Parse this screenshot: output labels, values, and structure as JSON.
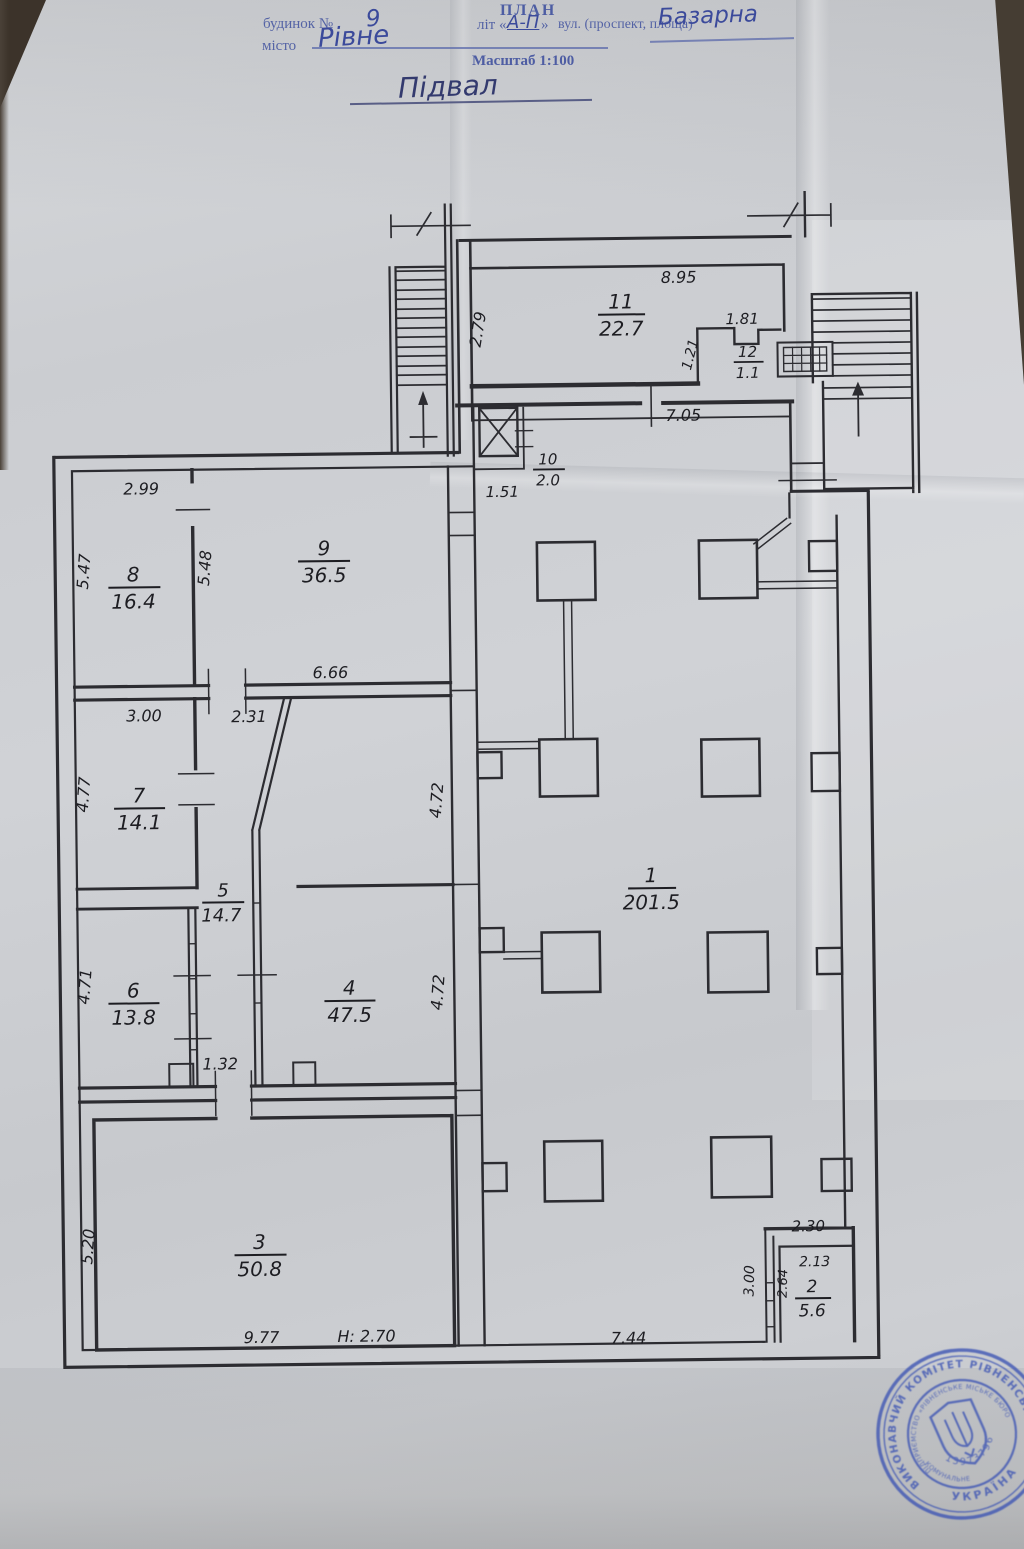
{
  "header": {
    "plan_stamp": "ПЛАН",
    "house_label": "будинок №",
    "house_number": "9",
    "lit_label": "літ «",
    "lit_value": "А-П",
    "lit_close": "»",
    "street_label": "вул. (проспект, площа)",
    "street_value": "Базарна",
    "city_label": "місто",
    "city_value": "Рівне",
    "scale_label": "Масштаб 1:100",
    "title": "Підвал"
  },
  "plan": {
    "rooms": [
      {
        "number": "1",
        "area": "201.5"
      },
      {
        "number": "2",
        "area": "5.6"
      },
      {
        "number": "3",
        "area": "50.8"
      },
      {
        "number": "4",
        "area": "47.5"
      },
      {
        "number": "5",
        "area": "14.7"
      },
      {
        "number": "6",
        "area": "13.8"
      },
      {
        "number": "7",
        "area": "14.1"
      },
      {
        "number": "8",
        "area": "16.4"
      },
      {
        "number": "9",
        "area": "36.5"
      },
      {
        "number": "10",
        "area": "2.0"
      },
      {
        "number": "11",
        "area": "22.7"
      },
      {
        "number": "12",
        "area": "1.1"
      }
    ],
    "dims": {
      "w299": "2.99",
      "h547": "5.47",
      "h548": "5.48",
      "w666": "6.66",
      "w300": "3.00",
      "h477": "4.77",
      "w231": "2.31",
      "h472a": "4.72",
      "h471": "4.71",
      "h472b": "4.72",
      "w132": "1.32",
      "h520": "5.20",
      "w977": "9.77",
      "h270": "Н: 2.70",
      "w895": "8.95",
      "h279": "2.79",
      "w181": "1.81",
      "h121": "1.21",
      "w705": "7.05",
      "w151": "1.51",
      "w230": "2.30",
      "w213": "2.13",
      "h300b": "3.00",
      "h264": "2.64",
      "w744": "7.44"
    }
  },
  "stamp": {
    "outer_text": "ВИКОНАВЧИЙ КОМІТЕТ РІВНЕНСЬКОЇ",
    "inner_text": "ПІДПРИЄМСТВО «РІВНЕНСЬКЕ МІСЬКЕ БЮРО",
    "left_text": "КОМУНАЛЬНЕ",
    "number": "13973796",
    "country": "УКРАЇНА"
  },
  "colors": {
    "ink": "#2c2c31",
    "blue": "#41529f",
    "stamp_blue": "#3f56b4"
  }
}
